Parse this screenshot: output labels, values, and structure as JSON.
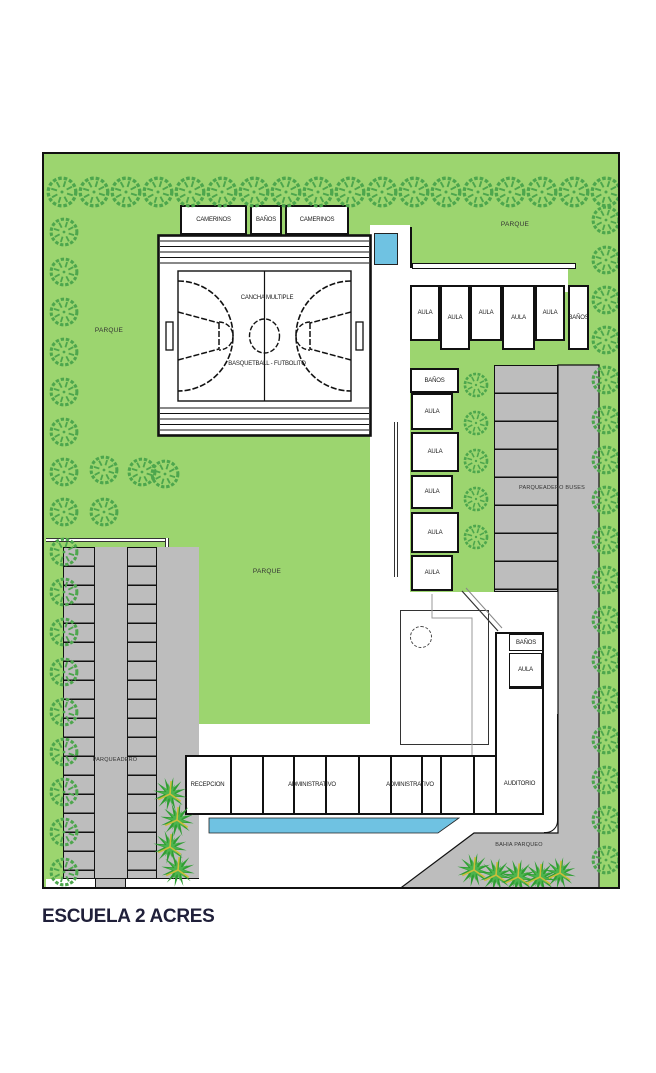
{
  "title": "ESCUELA 2 ACRES",
  "site": {
    "areas": {
      "parque_top_right": "PARQUE",
      "parque_left": "PARQUE",
      "parque_center": "PARQUE",
      "parqueadero": "PARQUEADERO",
      "parqueadero_buses": "PARQUEADERO BUSES",
      "bahia_parqueo": "BAHIA PARQUEO"
    },
    "court": {
      "name": "CANCHA MULTIPLE",
      "subtitle": "BASQUETBALL - FUTBOLITO"
    },
    "locker_row": [
      "CAMERINOS",
      "BAÑOS",
      "CAMERINOS"
    ],
    "classroom_row": [
      "AULA",
      "AULA",
      "AULA",
      "AULA",
      "AULA",
      "BAÑOS"
    ],
    "classroom_column": [
      "BAÑOS",
      "AULA",
      "AULA",
      "AULA",
      "AULA",
      "AULA"
    ],
    "auditorium": {
      "banos": "BAÑOS",
      "aula": "AULA",
      "label": "AUDITORIO"
    },
    "admin_row": {
      "recepcion": "RECEPCION",
      "administrativo_1": "ADMINISTRATIVO",
      "administrativo_2": "ADMINISTRATIVO"
    }
  },
  "icons": {
    "tree": "scalloped-circle-tree",
    "shrub": "spiky-bush"
  },
  "colors": {
    "grass": "#9CD56F",
    "tree": "#4DA64D",
    "paving": "#BDBDBD",
    "water": "#6FC2E2",
    "shrub": "#2F9E33",
    "shrub_light": "#4CB44F",
    "shrub_accent": "#CBBE3A",
    "ink": "#111111"
  }
}
